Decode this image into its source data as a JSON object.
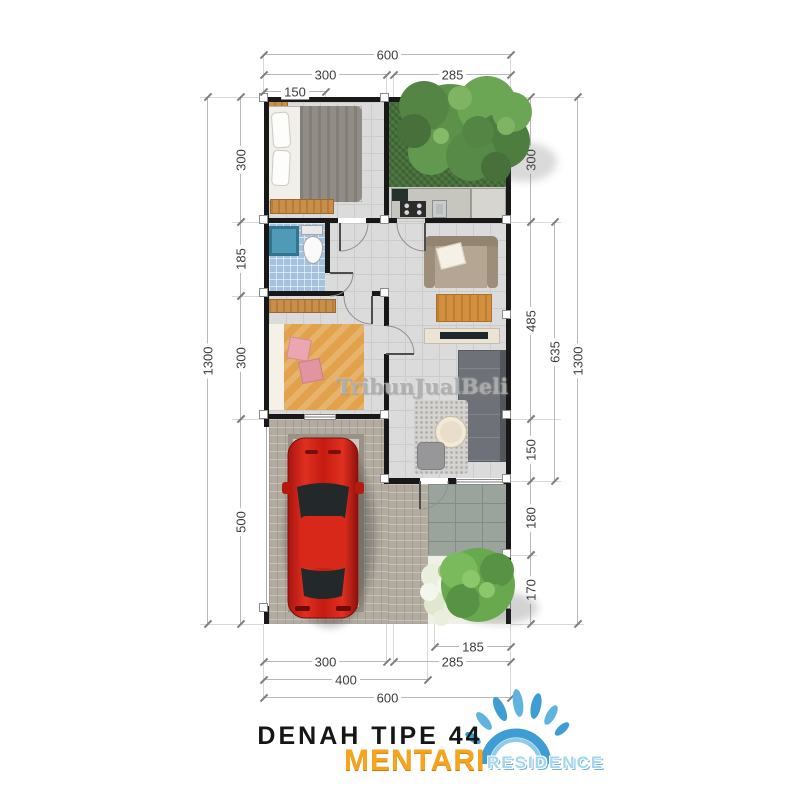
{
  "title": {
    "text": "DENAH TIPE 44"
  },
  "brand": {
    "primary": "MENTARI",
    "secondary": "RESIDENCE",
    "primary_color": "#F6A41E",
    "secondary_color": "#A5D6F0",
    "splash_color": "#3E9DD3"
  },
  "watermark": {
    "text": "TribunJualBeli"
  },
  "dims": {
    "top": [
      "600",
      "300",
      "285",
      "150"
    ],
    "left": [
      "1300",
      "300",
      "185",
      "300",
      "500"
    ],
    "right": [
      "300",
      "485",
      "150",
      "180",
      "170",
      "635",
      "1300"
    ],
    "bottom": [
      "185",
      "300",
      "285",
      "400",
      "600"
    ]
  }
}
